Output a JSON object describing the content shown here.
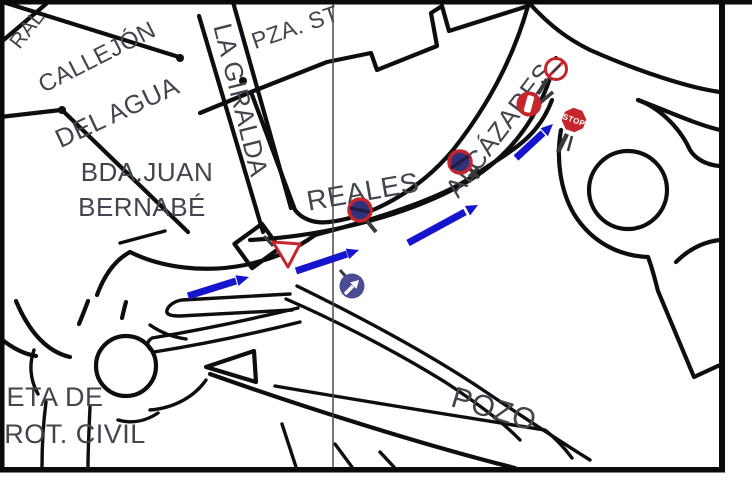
{
  "map": {
    "street_labels": {
      "ral": "RAL",
      "callejon": "CALLEJÓN",
      "del_agua": "DEL AGUA",
      "la_giralda": "LA GIRALDA",
      "pza_st": "PZA. ST",
      "bda_juan_line1": "BDA.JUAN",
      "bda_juan_line2": "BERNABÉ",
      "reales": "REALES",
      "alcazares": "ALCÁZARES",
      "pozo": "POZO",
      "eta_de": "ETA DE",
      "rot_civil": "ROT. CIVIL"
    },
    "signs": {
      "stop": {
        "label": "STOP"
      },
      "count": 7
    },
    "route_arrows": {
      "count": 4
    },
    "colors": {
      "background": "#ffffff",
      "road_line": "#0e0e0e",
      "label_text": "#41454e",
      "route_arrow_blue": "#1515cd",
      "sign_red": "#c5262c",
      "sign_navy_fill": "#32327c",
      "mandatory_sign_indigo": "#4c4c94",
      "sign_post_gray": "#3a3a3a",
      "fold_line_gray": "#4a4a4a"
    }
  }
}
